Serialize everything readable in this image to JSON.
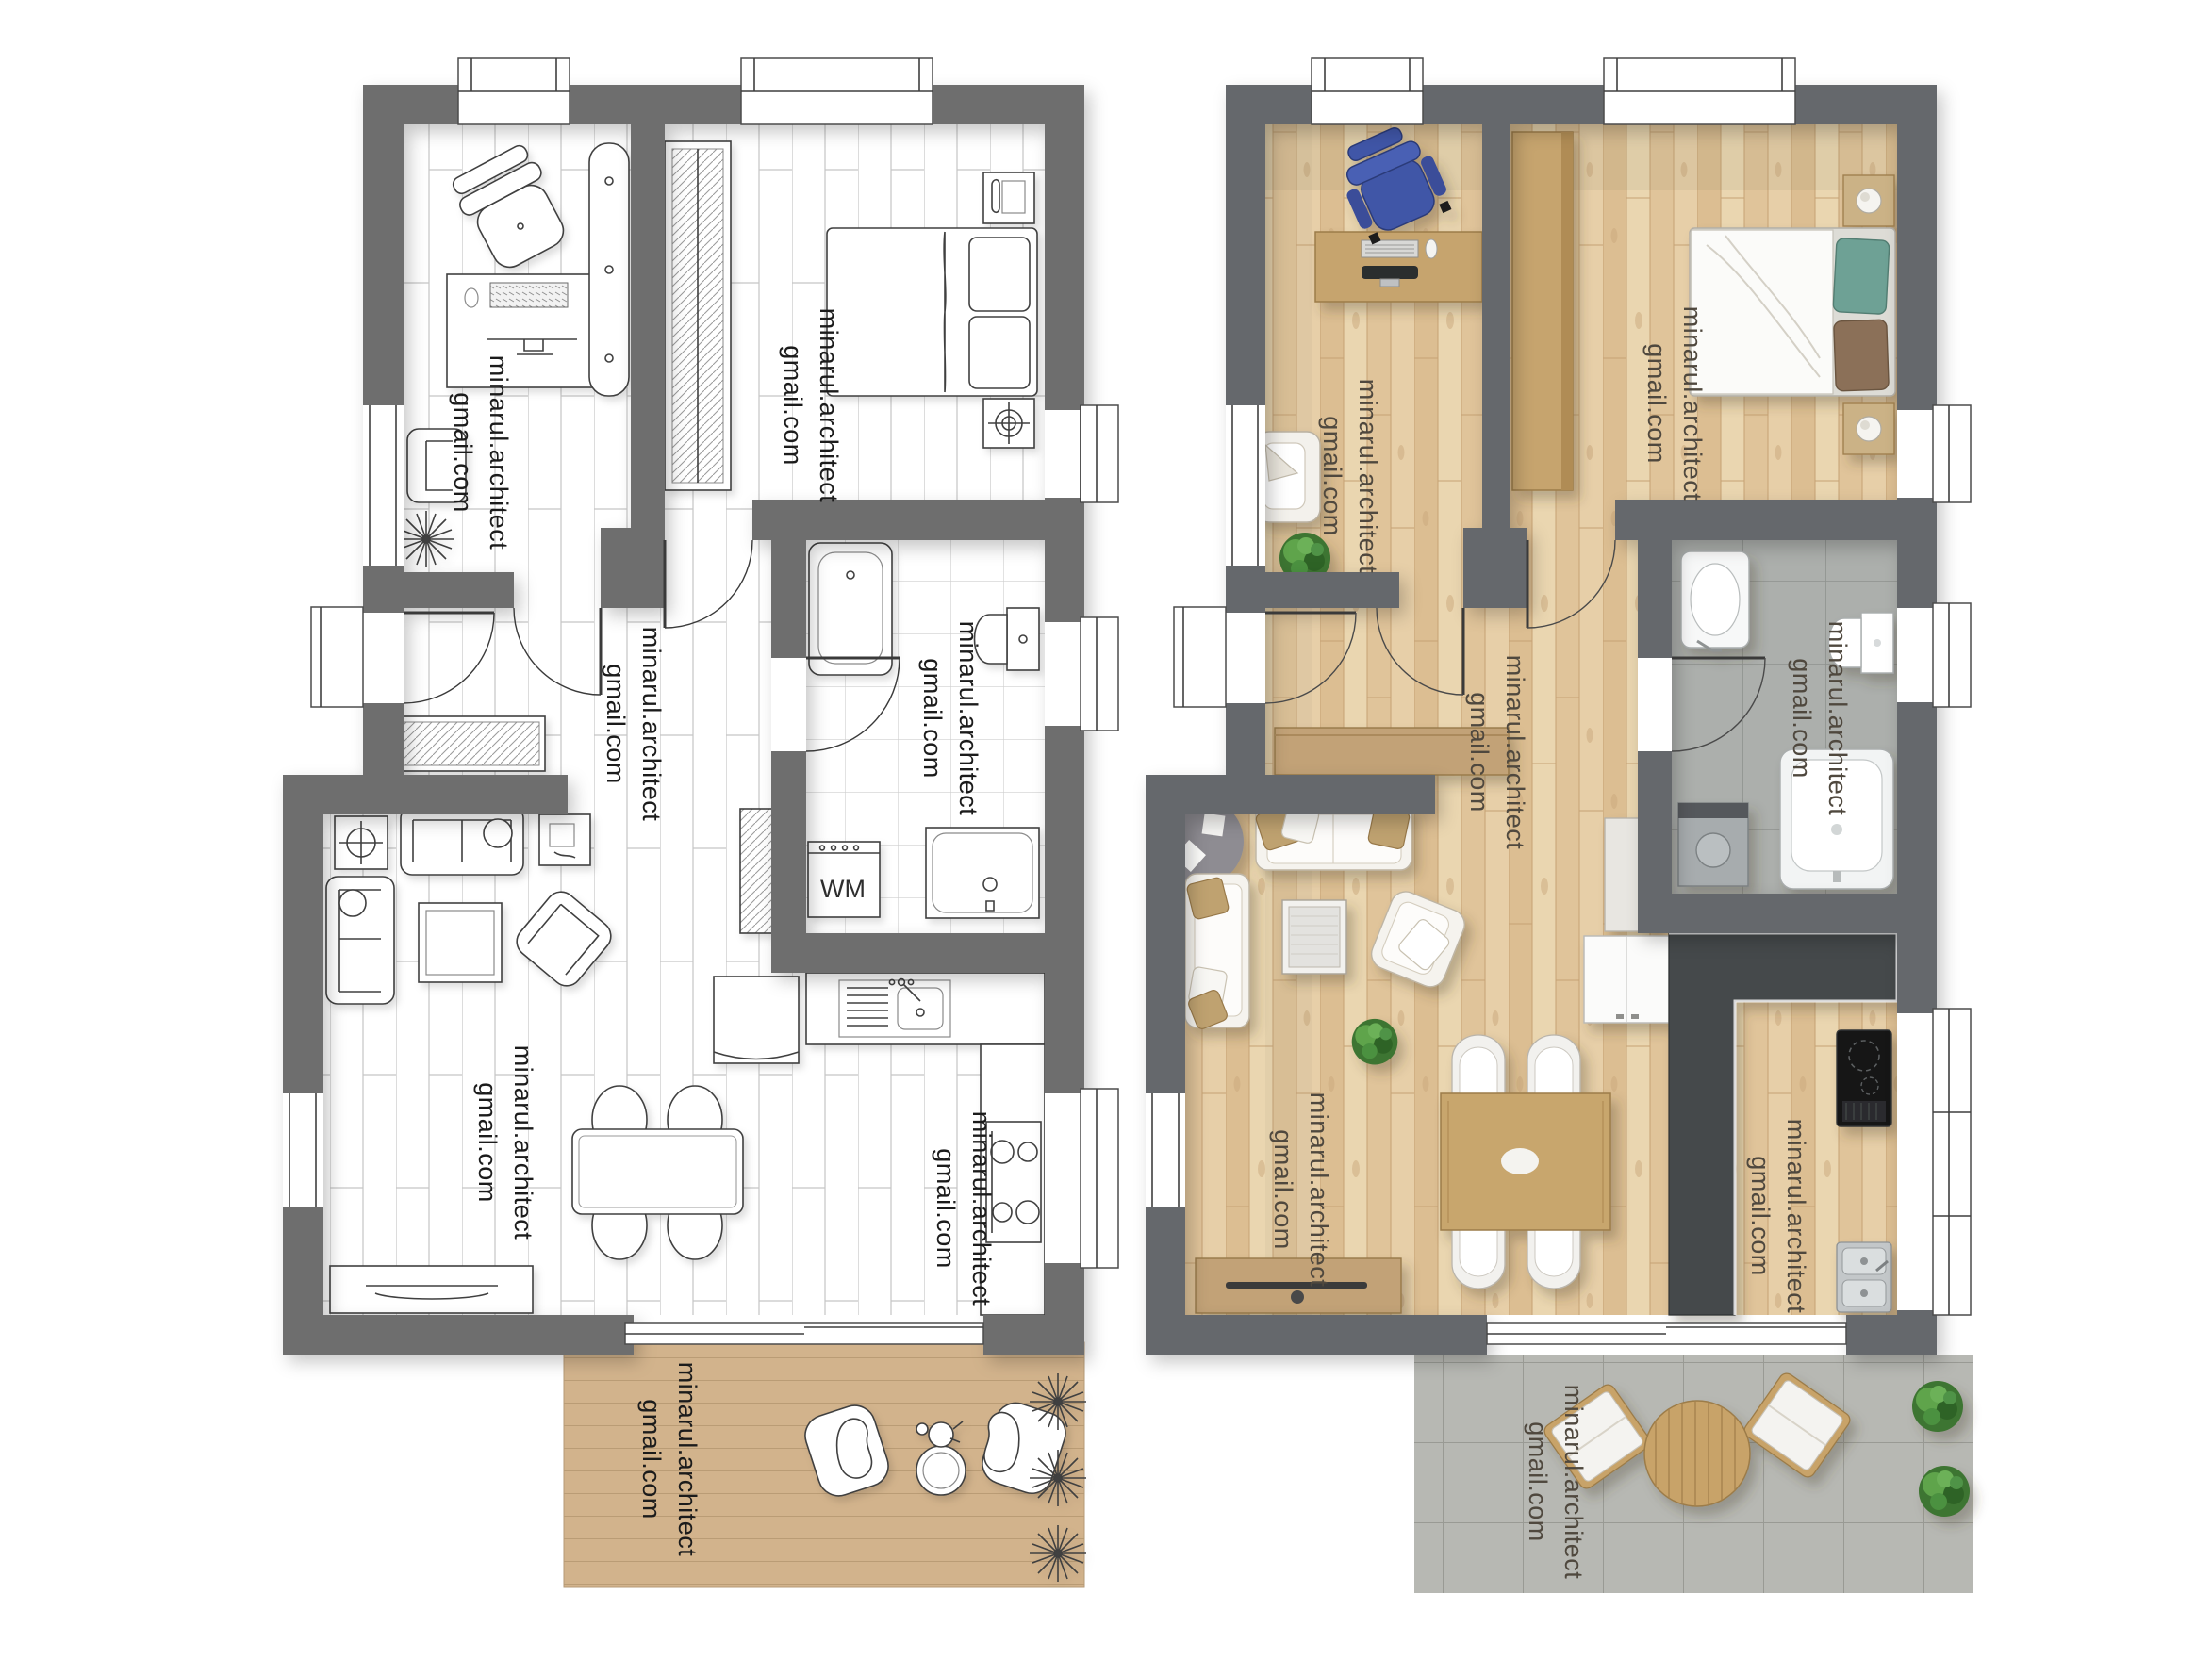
{
  "artwork": {
    "kind": "architectural floor plan presentation",
    "views": [
      {
        "id": "plan-monochrome",
        "description": "line-drawing apartment plan with wood terrace"
      },
      {
        "id": "plan-rendered",
        "description": "color rendered apartment plan with paver terrace"
      }
    ]
  },
  "watermark": {
    "line1": "minarul.architect",
    "line2": "gmail.com"
  },
  "labels": {
    "washing_machine": "WM"
  },
  "colors": {
    "background": "#ffffff",
    "wall_left_plan": "#6e6e6e",
    "wall_right_plan": "#65686c",
    "linework": "#3f3f3f",
    "deck_wood": "#d2b38c",
    "render_wood_floor": "#e4c9a0",
    "render_tile": "#abaeab",
    "render_paver": "#b7b8b3",
    "counter_charcoal": "#45484b",
    "cabinet_tan": "#c6a46e",
    "office_chair_blue": "#4156a7",
    "pillow_teal": "#6ea195",
    "pillow_brown": "#8b7058",
    "plant_green": "#47823a",
    "rug_gray": "#8e8c92",
    "watermark_left": "#1b1b1b",
    "watermark_right": "#4f483e"
  }
}
